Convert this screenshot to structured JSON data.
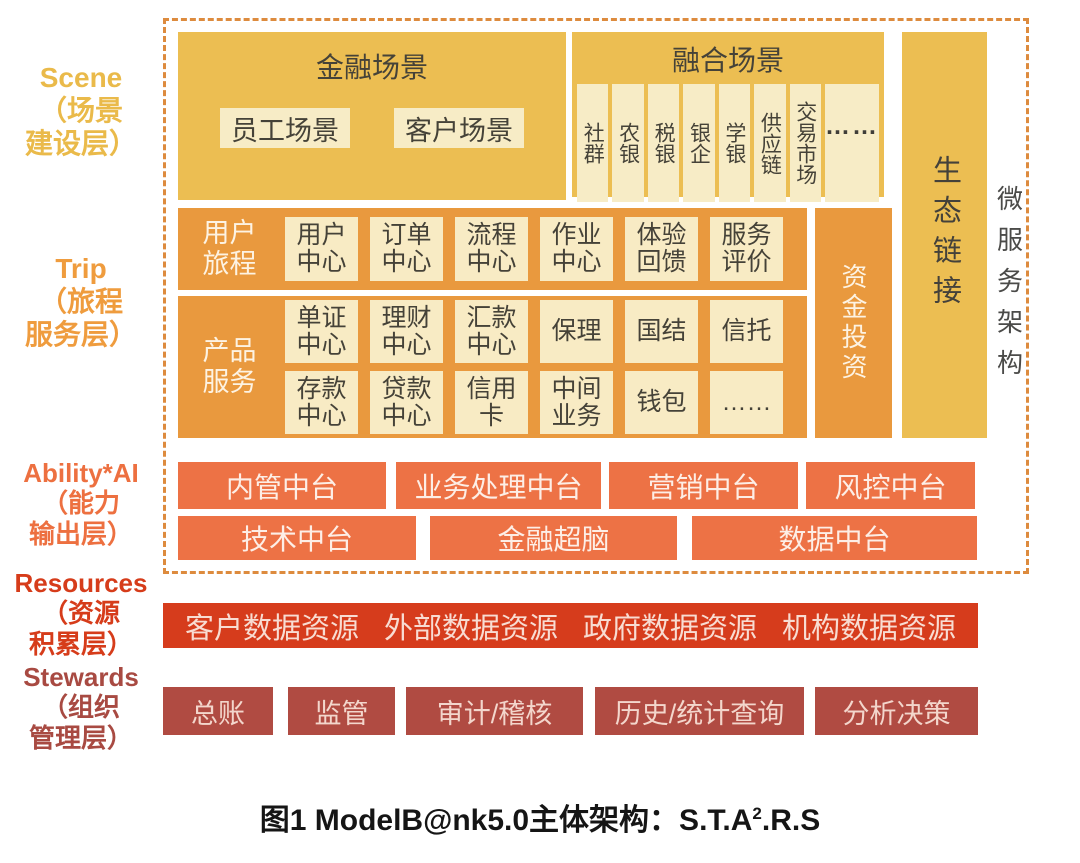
{
  "colors": {
    "golden_block": "#ecbe52",
    "cream_box": "#f7ecc6",
    "orange_block": "#e9993e",
    "coral_block": "#ed7245",
    "red_bar": "#d63c1c",
    "brick_box": "#b04b42",
    "dashed_border": "#dd8b3e",
    "scene_label": "#eaba4a",
    "trip_label": "#ef9c3e",
    "ability_label": "#ed7040",
    "resources_label": "#d63c1a",
    "stewards_label": "#a84a42"
  },
  "layer_labels": {
    "scene": {
      "lines": [
        "Scene",
        "（场景",
        "建设层）"
      ]
    },
    "trip": {
      "lines": [
        "Trip",
        "（旅程",
        "服务层）"
      ]
    },
    "ability": {
      "lines": [
        "Ability*AI",
        "（能力",
        "输出层）"
      ]
    },
    "resources": {
      "lines": [
        "Resources",
        "（资源",
        "积累层）"
      ]
    },
    "stewards": {
      "lines": [
        "Stewards",
        "（组织",
        "管理层）"
      ]
    }
  },
  "scene": {
    "financial": {
      "title": "金融场景",
      "boxes": [
        "员工场景",
        "客户场景"
      ]
    },
    "fusion": {
      "title": "融合场景",
      "columns": [
        "社群",
        "农银",
        "税银",
        "银企",
        "学银",
        "供应链",
        "交易市场",
        "……"
      ]
    },
    "eco_link": "生态链接",
    "microservice": "微服务架构"
  },
  "trip": {
    "journey": {
      "label": "用户旅程",
      "cells": [
        "用户中心",
        "订单中心",
        "流程中心",
        "作业中心",
        "体验回馈",
        "服务评价"
      ]
    },
    "product": {
      "label": "产品服务",
      "row1": [
        "单证中心",
        "理财中心",
        "汇款中心",
        "保理",
        "国结",
        "信托"
      ],
      "row2": [
        "存款中心",
        "贷款中心",
        "信用卡",
        "中间业务",
        "钱包",
        "……"
      ]
    },
    "capital": "资金投资"
  },
  "ability": {
    "row1": [
      "内管中台",
      "业务处理中台",
      "营销中台",
      "风控中台"
    ],
    "row2": [
      "技术中台",
      "金融超脑",
      "数据中台"
    ]
  },
  "resources": {
    "items": [
      "客户数据资源",
      "外部数据资源",
      "政府数据资源",
      "机构数据资源"
    ]
  },
  "stewards": {
    "items": [
      "总账",
      "监管",
      "审计/稽核",
      "历史/统计查询",
      "分析决策"
    ]
  },
  "caption": {
    "prefix": "图1 ModelB@nk5.0主体架构：S.T.A",
    "sup": "2",
    "suffix": ".R.S"
  }
}
